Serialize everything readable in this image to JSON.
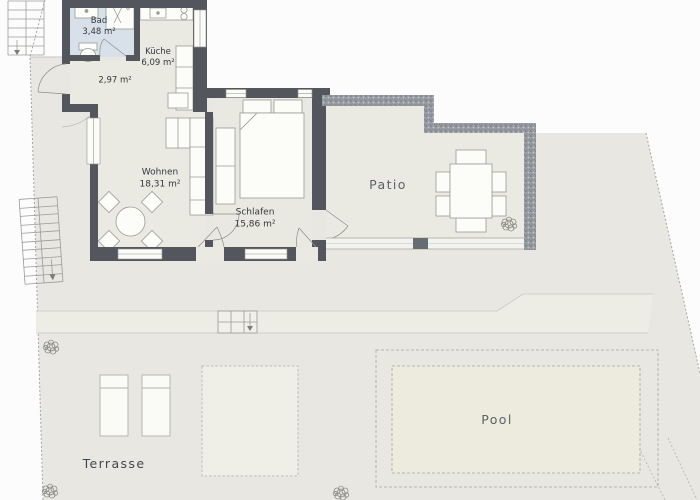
{
  "plan": {
    "rooms": {
      "bad": {
        "name": "Bad",
        "area": "3,48 m²"
      },
      "kueche": {
        "name": "Küche",
        "area": "6,09 m²"
      },
      "flur": {
        "area": "2,97 m²"
      },
      "wohnen": {
        "name": "Wohnen",
        "area": "18,31 m²"
      },
      "schlafen": {
        "name": "Schlafen",
        "area": "15,86 m²"
      }
    },
    "outdoor": {
      "patio": "Patio",
      "pool": "Pool",
      "terrasse": "Terrasse"
    },
    "colors": {
      "wall": "#53575d",
      "bath_floor": "#d8e0e9",
      "room_floor": "#eae9e2",
      "ground": "#e8e7e2",
      "outside": "#fcfcfd",
      "pool_fill": "#edebdd",
      "label_text": "#34383d",
      "outdoor_text": "#5d6269"
    }
  }
}
